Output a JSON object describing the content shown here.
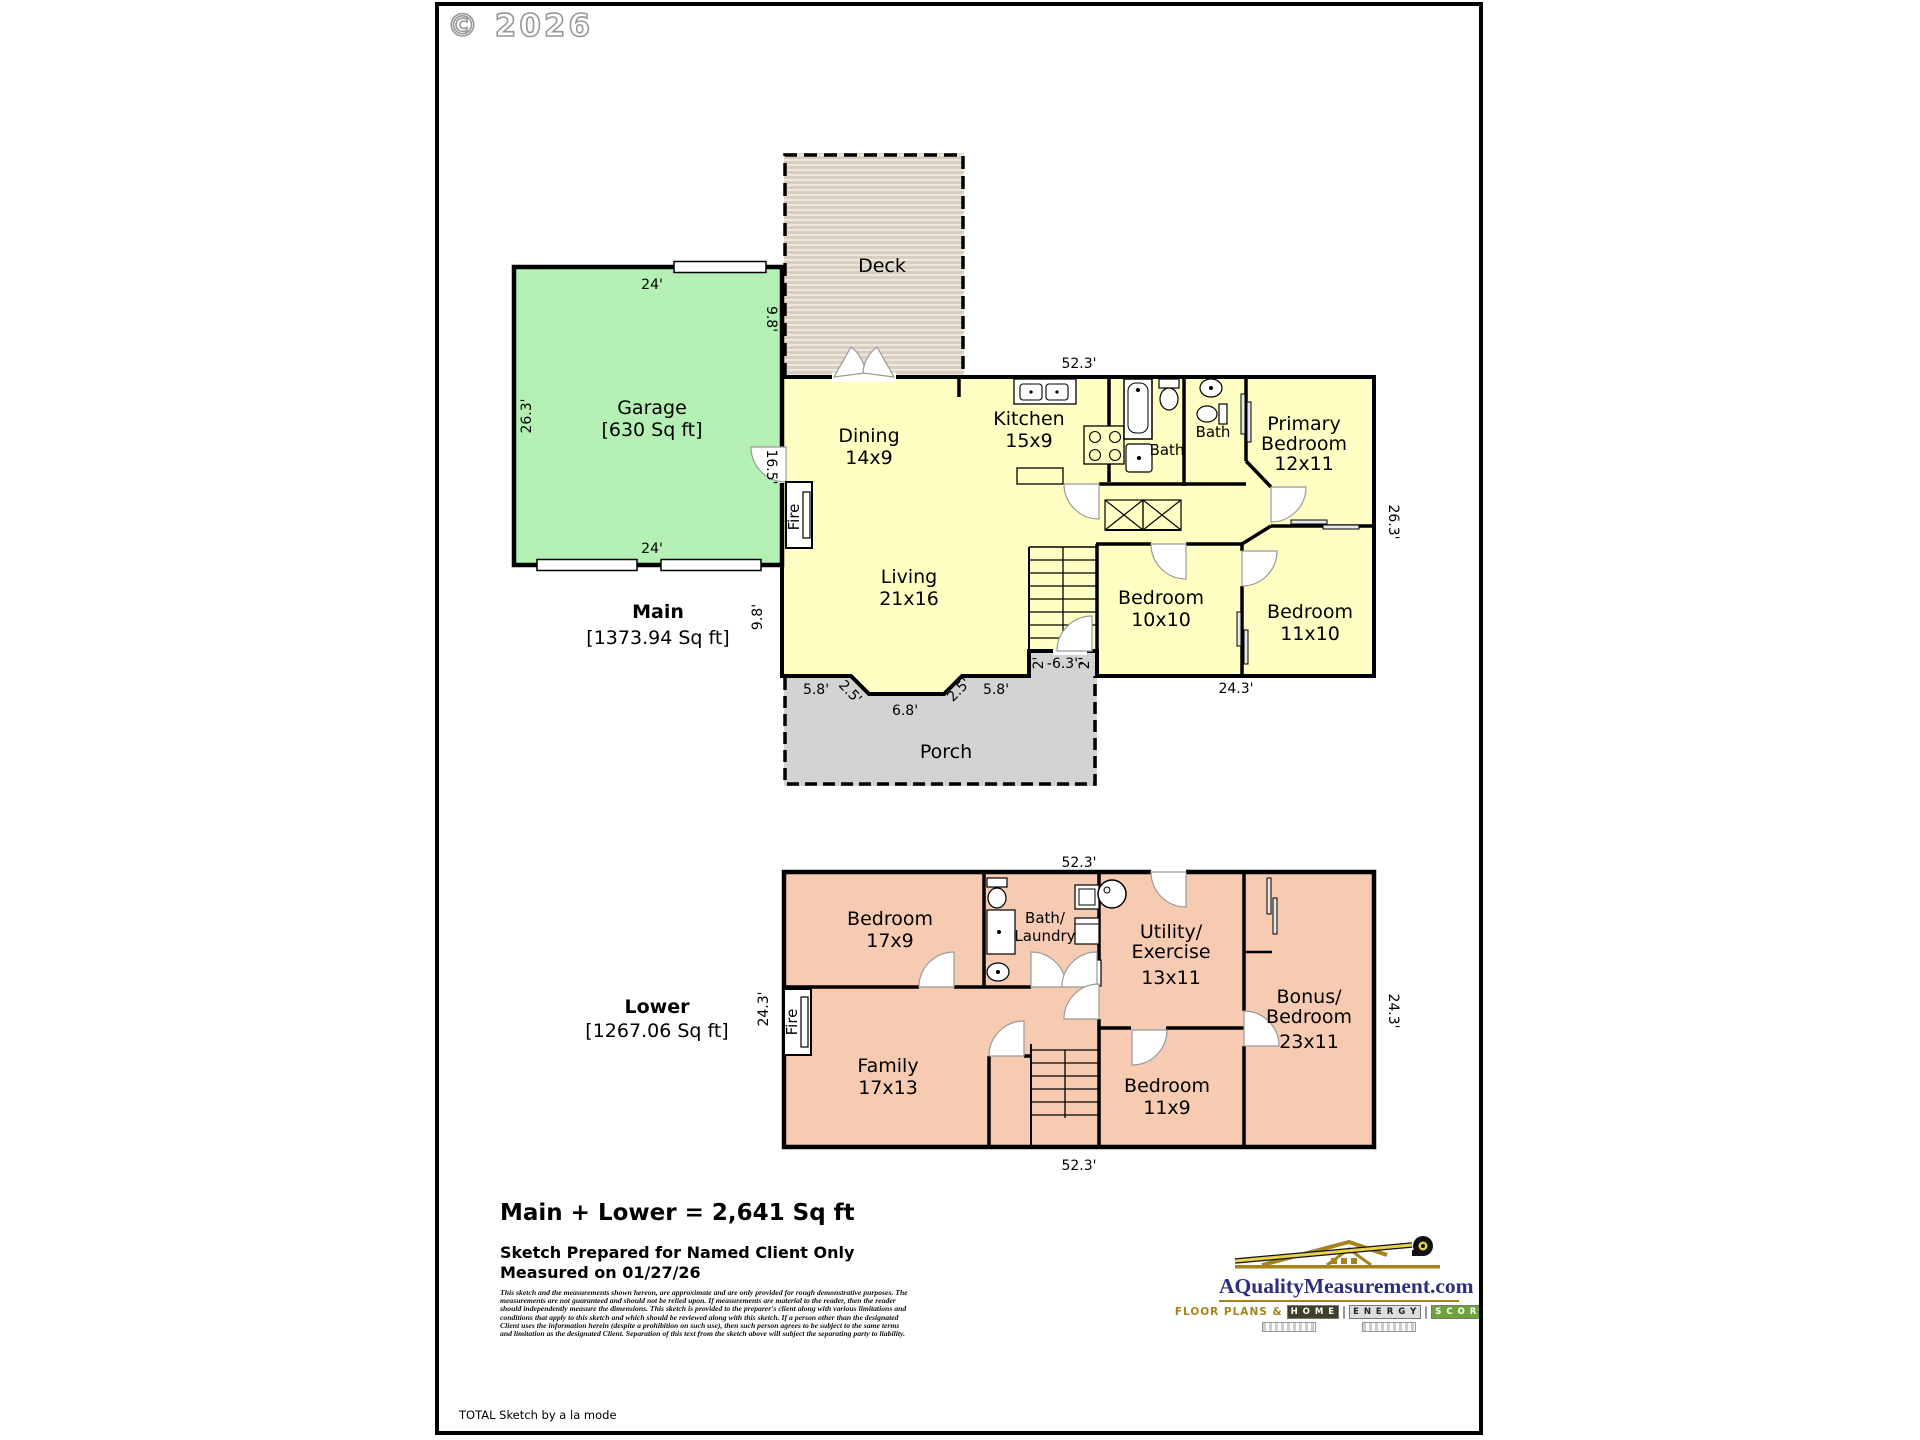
{
  "watermark": "© 2026",
  "colors": {
    "main_floor": "#ffffc3",
    "garage": "#b4f0b4",
    "lower_floor": "#f7cbb2",
    "porch": "#d3d3d3",
    "deck": "#d8cec2",
    "logo_navy": "#2e2e7d",
    "logo_gold": "#a5841e",
    "scores_green": "#6da33a"
  },
  "main": {
    "title": "Main",
    "area": "[1373.94 Sq ft]",
    "garage_1": "Garage",
    "garage_2": "[630 Sq ft]",
    "deck": "Deck",
    "dining_1": "Dining",
    "dining_2": "14x9",
    "kitchen_1": "Kitchen",
    "kitchen_2": "15x9",
    "bath_hall": "Bath",
    "bath_primary": "Bath",
    "primary_1": "Primary",
    "primary_2": "Bedroom",
    "primary_3": "12x11",
    "living_1": "Living",
    "living_2": "21x16",
    "bed10_1": "Bedroom",
    "bed10_2": "10x10",
    "bed11_1": "Bedroom",
    "bed11_2": "11x10",
    "porch": "Porch",
    "fire": "Fire",
    "dims": {
      "top": "52.3'",
      "right": "26.3'",
      "bottom": "24.3'",
      "garage_top": "24'",
      "garage_bottom": "24'",
      "garage_left": "26.3'",
      "deck_side": "9.8'",
      "garage_door_side": "16.5'",
      "living_left": "9.8'",
      "porch_a": "5.8'",
      "porch_b": "2.5'",
      "porch_c": "6.8'",
      "porch_d": "2.5'",
      "porch_e": "5.8'",
      "entry_a": "2'",
      "entry_b": "-6.3'-",
      "entry_c": "2'"
    }
  },
  "lower": {
    "title": "Lower",
    "area": "[1267.06 Sq ft]",
    "bed17_1": "Bedroom",
    "bed17_2": "17x9",
    "bathlaundry_1": "Bath/",
    "bathlaundry_2": "Laundry",
    "utility_1": "Utility/",
    "utility_2": "Exercise",
    "utility_3": "13x11",
    "bonus_1": "Bonus/",
    "bonus_2": "Bedroom",
    "bonus_3": "23x11",
    "family_1": "Family",
    "family_2": "17x13",
    "bed11_1": "Bedroom",
    "bed11_2": "11x9",
    "fire": "Fire",
    "dims": {
      "top": "52.3'",
      "bottom": "52.3'",
      "left": "24.3'",
      "right": "24.3'"
    }
  },
  "footer": {
    "total": "Main + Lower = 2,641 Sq ft",
    "prepared": "Sketch Prepared for Named Client Only",
    "measured": "Measured on 01/27/26",
    "disclaimer": "This sketch and the measurements shown hereon, are approximate and are only provided for rough demonstrative purposes. The measurements are not guaranteed and should not be relied upon.  If measurements are material to the reader, then the reader should independently measure the dimensions.  This sketch is provided to the preparer's client along with various limitations and conditions that apply to this sketch and which should be reviewed along with this sketch.  If a person other than the designated Client uses the information herein (despite a prohibition on such use), then such person agrees to be subject to the same terms and limitation as the designated Client.  Separation of this text from the sketch above will subject the separating party to liability.",
    "credit": "TOTAL Sketch by a la mode"
  },
  "logo": {
    "site": "AQualityMeasurement.com",
    "tagline": "Floor Plans &",
    "b1": "H O M E",
    "b2": "E N E R G Y",
    "b3": "S C O R E S"
  }
}
